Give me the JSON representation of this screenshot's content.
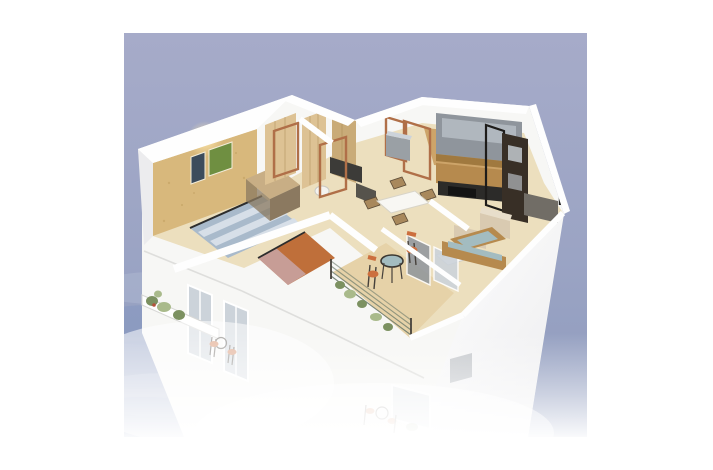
{
  "meta": {
    "title": "3D isometric cutaway floor plan render of an apartment building",
    "view": "aerial isometric cutaway of top floor, lower floors fading into haze",
    "visible_text": "none (watermark illegible)"
  },
  "scene": {
    "rooms": [
      {
        "name": "master-bedroom",
        "features": [
          "textured tan feature wall",
          "two wall pictures",
          "warm ceiling light",
          "blue striped double bed",
          "brown wardrobe"
        ]
      },
      {
        "name": "second-bedroom",
        "features": [
          "terracotta orange bed with mauve head section"
        ]
      },
      {
        "name": "bathroom-passage",
        "features": [
          "pine wood panel walls",
          "copper open door frames",
          "dark vanity counter",
          "white wc"
        ]
      },
      {
        "name": "kitchen",
        "features": [
          "large gray window",
          "wooden cabinets",
          "dark countertop with hob",
          "gray appliance"
        ]
      },
      {
        "name": "dining-area",
        "features": [
          "white top table",
          "four wooden chairs"
        ]
      },
      {
        "name": "living-room",
        "features": [
          "tall dark tv unit",
          "tv",
          "beige l-sofa",
          "wood and glass coffee table",
          "white sideboard"
        ]
      },
      {
        "name": "balcony-terrace",
        "features": [
          "wire railing",
          "round glass bistro table",
          "iron chairs with orange cushions",
          "planter greenery",
          "sliding glass doors",
          "wood bench with teal glass"
        ]
      },
      {
        "name": "lower-floors",
        "features": [
          "tall gray windows",
          "left balcony with plants and bistro set",
          "lower balcony with bistro set",
          "white mist at base"
        ]
      }
    ]
  },
  "palette": {
    "page_bg": "#ffffff",
    "sky_top": "#a6abc9",
    "sky_mid": "#9ba4c4",
    "sky_bottom": "#8e9bbd",
    "cloud_dark": "#8094bf",
    "cloud_light": "#bac4da",
    "haze_white": "#ffffff",
    "bldg_white": "#f7f7f5",
    "bldg_face": "#ececee",
    "bldg_shade": "#e0e1e5",
    "wall_top": "#fefefe",
    "slab_shadow": "#d8d8d6",
    "floor_cream": "#ecdfbe",
    "floor_warm": "#e6d2a8",
    "kitchen_floor": "#c89a5a",
    "bedroom_wall": "#d8b87c",
    "bedroom_wall_dot": "#b4934f",
    "picture_dark": "#3c4c5c",
    "picture_green": "#6f8f41",
    "glow": "#ffe9ae",
    "bed_blue_a": "#a9bacb",
    "bed_blue_b": "#d7dfe8",
    "bed_dark_line": "#2d2d2d",
    "wardrobe_brown": "#8b7960",
    "wardrobe_light": "#c8ae85",
    "bed_orange": "#bf6f3a",
    "bed_mauve": "#c79d96",
    "wood_panel": "#ddc294",
    "wood_panel_dark": "#c9ab78",
    "copper": "#b06f48",
    "fixture_dark": "#3c3b38",
    "fixture_white": "#f4f3ef",
    "appliance_gray": "#9aa0a5",
    "window_gray": "#8f959c",
    "window_light": "#ccd3da",
    "window_trim": "#a0793f",
    "counter_dark": "#2c2b29",
    "hob_black": "#141414",
    "cabinet_wood": "#b68a4e",
    "tv_unit": "#382f26",
    "tv_screen": "#716d66",
    "door_black": "#1e1c1a",
    "sofa_beige": "#d9cab1",
    "sofa_light": "#e8decb",
    "table_white": "#f8f7f3",
    "chair_wood": "#a8885c",
    "iron_dark": "#46413b",
    "glass_teal": "#a3bcc0",
    "cushion_orange": "#cc6f3e",
    "plant_green": "#7c9161",
    "plant_light": "#a9ba8b",
    "plant_red": "#b5523c",
    "rail_wire": "#6b7a6b"
  }
}
